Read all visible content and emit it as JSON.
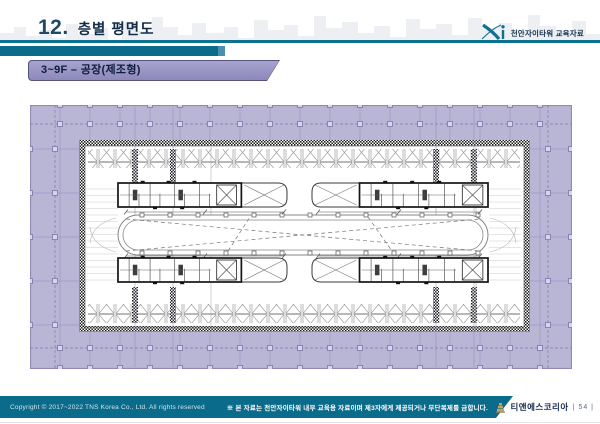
{
  "header": {
    "title_number": "12.",
    "title": "층별 평면도",
    "brand_logo": "Xi",
    "brand_caption": "천안자이타워 교육자료"
  },
  "subtitle_bar": {
    "label": "3~9F – 공장(제조형)"
  },
  "floor_plan": {
    "type": "architectural floor plan drawing",
    "content": "공장(제조형) 층 평면도",
    "colors": {
      "outer_zone": "#b9b5d5",
      "grid_line": "#8e8abb",
      "wall_hatch": "#1a1a1a",
      "drawing_line": "#555555"
    }
  },
  "footer": {
    "copyright": "Copyright © 2017~2022 TNS Korea Co., Ltd. All rights reserved",
    "notice": "※ 본 자료는 천안자이타워 내부 교육용 자료이며 제3자에게 제공되거나 무단복제를 금합니다.",
    "company": "티앤에스코리아",
    "page_display": "| 54 |"
  },
  "theme": {
    "teal": "#0b6b8a",
    "navy_text": "#122c49",
    "purple_bar": "#8f8cbd",
    "lavender": "#b9b5d5"
  }
}
